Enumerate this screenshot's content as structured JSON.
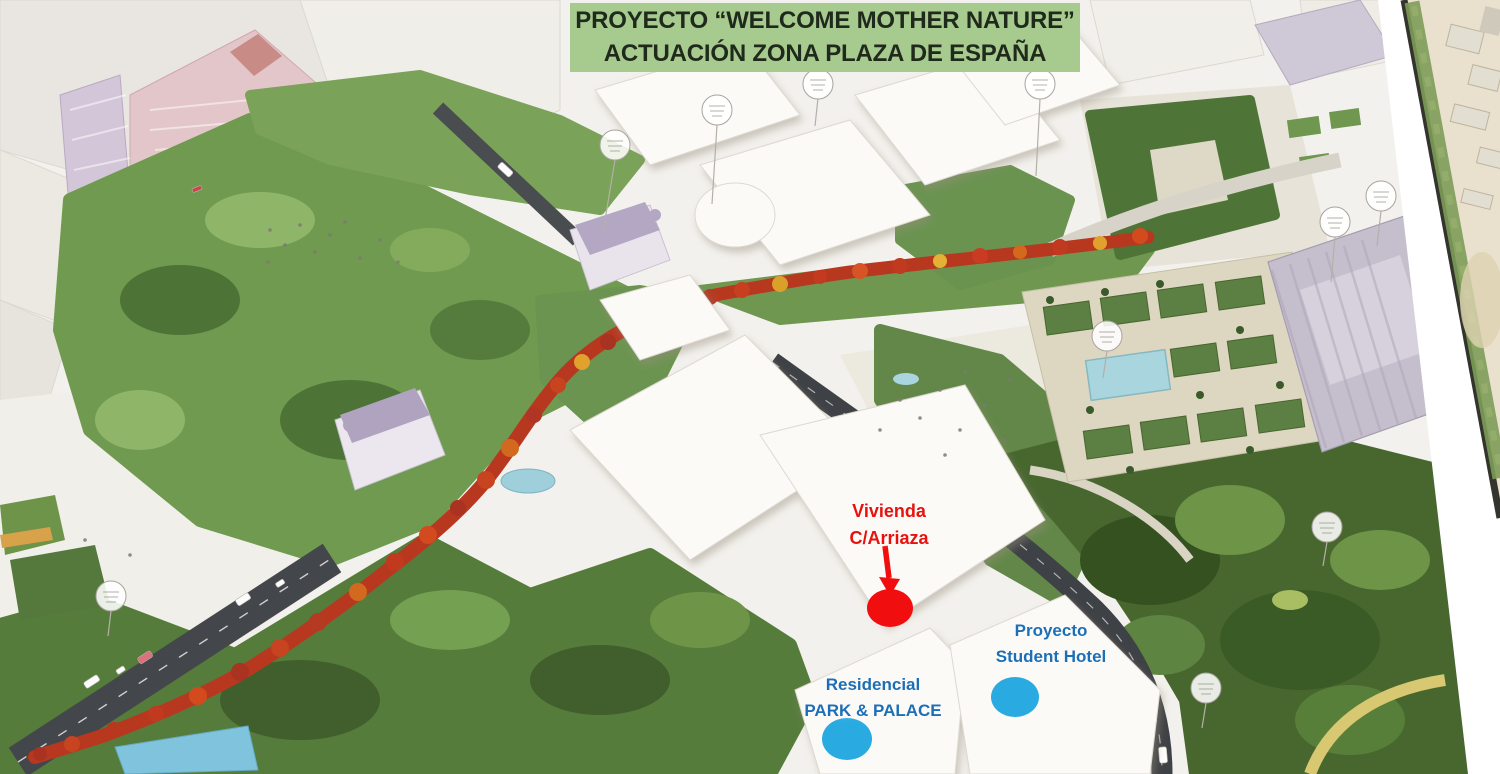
{
  "banner": {
    "line1": "PROYECTO “WELCOME MOTHER NATURE”",
    "line2": "ACTUACIÓN ZONA PLAZA DE ESPAÑA",
    "background": "#a7ca8e",
    "text_color": "#1f2a1c"
  },
  "annotations": {
    "vivienda": {
      "line1": "Vivienda",
      "line2": "C/Arriaza",
      "text_color": "#e8120c",
      "marker_color": "#f10e0e",
      "marker_shape": "ellipse",
      "pointer": "arrow-down"
    },
    "student_hotel": {
      "line1": "Proyecto",
      "line2": "Student Hotel",
      "text_color": "#1d6fb5",
      "marker_color": "#29abe2",
      "marker_shape": "ellipse"
    },
    "park_palace": {
      "line1": "Residencial",
      "line2": "PARK & PALACE",
      "text_color": "#1d6fb5",
      "marker_color": "#29abe2",
      "marker_shape": "ellipse"
    }
  }
}
